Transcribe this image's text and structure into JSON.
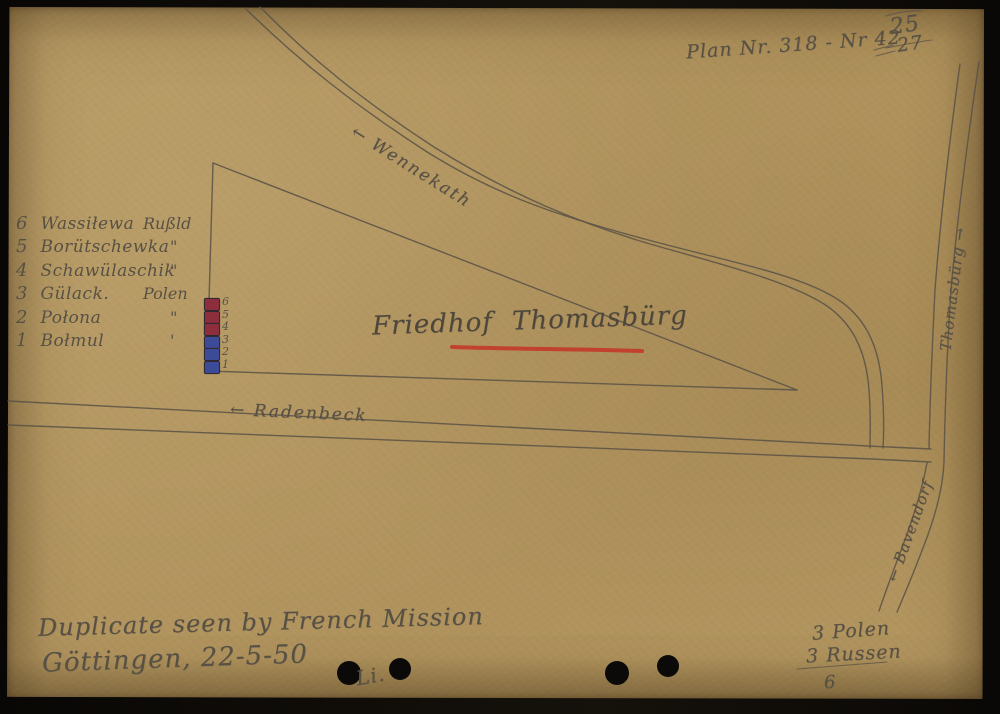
{
  "page": {
    "plan_label": "Plan Nr. 318 - Nr 42",
    "number_revision": "25",
    "number_crossed_out": "27"
  },
  "map": {
    "site_label": {
      "word1": "Friedhof",
      "word2": "Thomasbürg"
    },
    "roads": {
      "wennekath": "← Wennekath",
      "radenbeck": "← Radenbeck",
      "thomasburg": "Thomasbürg →",
      "bavendorf": "← Bavendorf"
    },
    "plot_numbers": [
      "6",
      "5",
      "4",
      "3",
      "2",
      "1"
    ]
  },
  "grave_list": [
    {
      "num": "6",
      "name": "Wassiłewa",
      "nationality": "Rußld"
    },
    {
      "num": "5",
      "name": "Borütschewka",
      "nationality": "\""
    },
    {
      "num": "4",
      "name": "Schawülaschik",
      "nationality": "\""
    },
    {
      "num": "3",
      "name": "Gülack.",
      "nationality": "Polen"
    },
    {
      "num": "2",
      "name": "Połona",
      "nationality": "\""
    },
    {
      "num": "1",
      "name": "Bołmul",
      "nationality": "'"
    }
  ],
  "annotations": {
    "duplicate_line1": "Duplicate seen by French Mission",
    "duplicate_line2": "Göttingen, 22-5-50",
    "signature": "Li.",
    "tally_polen": "3 Polen",
    "tally_russen": "3 Russen",
    "tally_total": "6"
  },
  "colors": {
    "paper": "#b2955f",
    "pencil": "#575044",
    "red_ink": "#c23b2b",
    "grave_red": "#8d2e3c",
    "grave_blue": "#3c4b97"
  }
}
